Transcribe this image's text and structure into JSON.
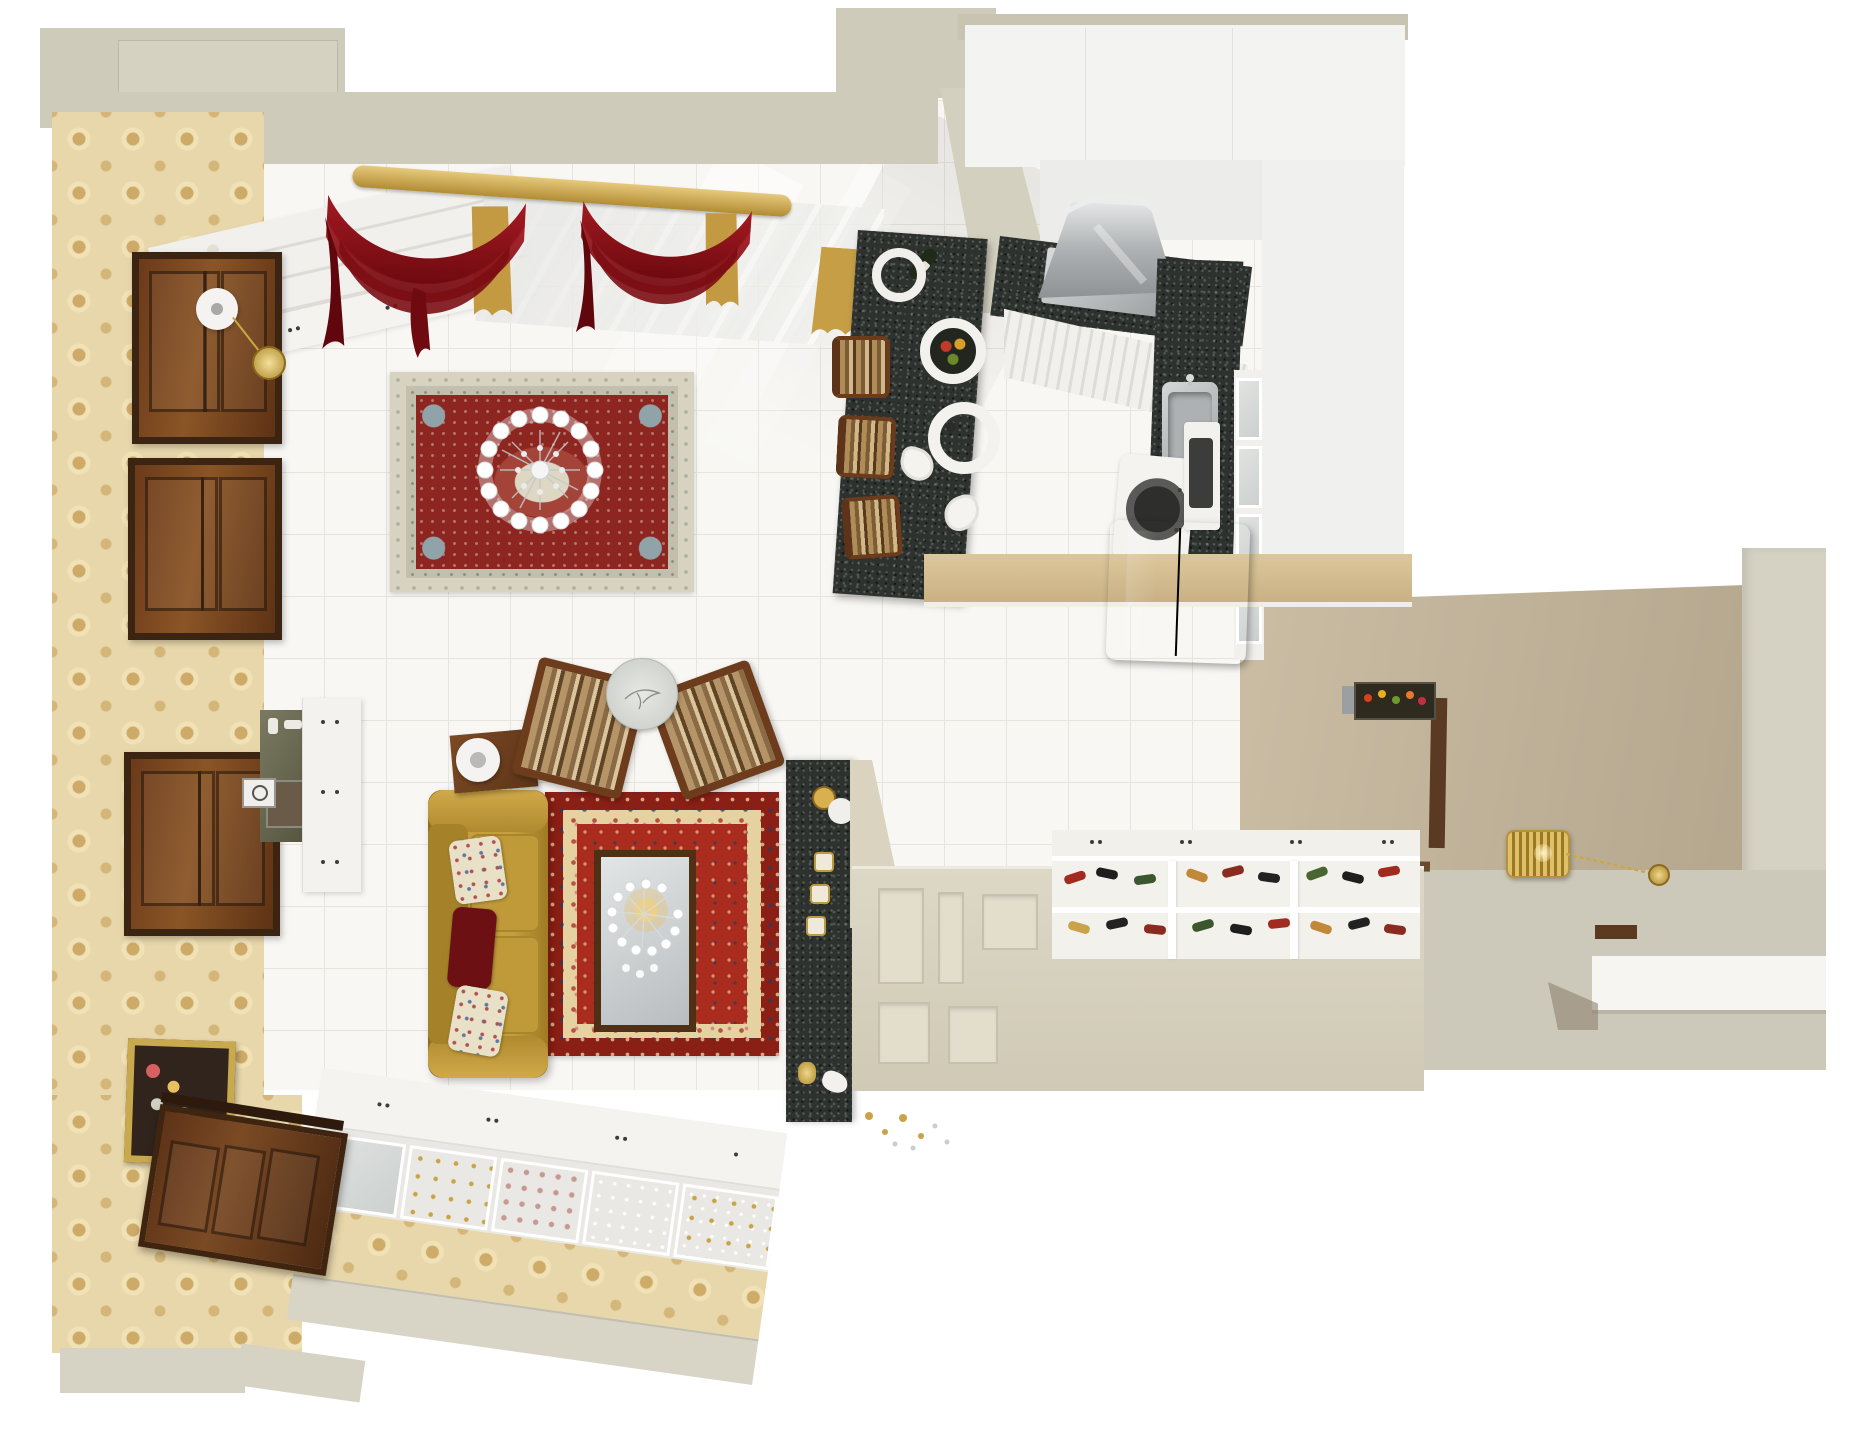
{
  "meta": {
    "title": "Bird's-eye 3D render of an apartment interior",
    "style": "photorealistic top-down floor plan",
    "canvas": {
      "width_px": 1864,
      "height_px": 1440
    }
  },
  "palette": {
    "outer_wall": "#cfcbba",
    "wallpaper_damask": "#e8d7ab",
    "damask_motif": "#cda864",
    "tile_floor": "#f8f7f4",
    "tile_grout": "#e7e4de",
    "bookshelf_white": "#f1f0ed",
    "curtain_burgundy": "#7c0d13",
    "curtain_sheer_gold": "#c49c44",
    "curtain_rod_gold": "#d9b85c",
    "rug_main_border_cream": "#d7d3c0",
    "rug_main_field_red": "#8d2520",
    "rug_accent_blue": "#8fa3a8",
    "rug_small_border_red": "#8a1f15",
    "rug_small_field_red": "#a92c1f",
    "rug_small_navy": "#33476b",
    "sofa_gold": "#bb9332",
    "pillow_burgundy": "#6d1014",
    "pillow_floral_cream": "#e8dfc6",
    "wood_dark": "#6b3a1a",
    "granite_black": "#2e322f",
    "stainless_steel": "#c8cacb",
    "fridge_black": "#121212",
    "appliance_white": "#f3f2ef",
    "cabinet_white": "#f4f3f0",
    "entry_wall_taupe": "#c5b79d",
    "partition_beige": "#d7d1be",
    "lantern_gold": "#d9b85c",
    "mirror_glass": "#d3d6d8"
  },
  "rooms": {
    "living_room": {
      "label": "Living room",
      "floor": "white ceramic tile",
      "west_wall": {
        "finish": "beige damask wallpaper",
        "wood_panels": 3,
        "painting": "gold-framed floral still life",
        "wall_clock_with_pendulum": true
      },
      "north_wall": {
        "bookshelf": "white shelving filled with books",
        "windows": "gold rod with burgundy swag curtains and gold sheers",
        "curtain_swags": 2
      },
      "area_rug_main": {
        "style": "Persian, cream border with red medallion field",
        "chandelier_above": "crystal ring with white candle cups"
      },
      "area_rug_small": {
        "style": "Persian, red field with navy and cream ornament",
        "mirrored_coffee_table": "dark wood frame",
        "chandelier_above": "crystal with warm gold glow"
      },
      "sofa": {
        "upholstery": "mustard gold",
        "pillows": [
          "cream floral",
          "burgundy",
          "cream floral"
        ]
      },
      "armchairs": {
        "count": 2,
        "upholstery": "brown striped",
        "frame": "dark wood"
      },
      "round_table": "glass top with etched branch",
      "side_table": {
        "material": "dark wood",
        "lamp": "white globe"
      },
      "storage": {
        "white_sideboard": true,
        "olive_console_with_mirror": true,
        "small_clock": true
      },
      "south_wall": {
        "display_cabinets": "white with glass doors and crystalware",
        "wallpaper_band": "beige damask",
        "entry_door": "dark panelled wood"
      },
      "granite_console": {
        "material": "black granite",
        "decor": [
          "gold candlesticks",
          "white tray",
          "gold vase"
        ]
      }
    },
    "kitchen": {
      "label": "Kitchen",
      "cabinets": "white",
      "counters": "black speckled granite",
      "range_hood": "stainless steel",
      "cooktop": "stainless with dark burners",
      "sink": "stainless single bowl with faucet",
      "appliances": [
        "white washing machine",
        "white microwave",
        "glossy black refrigerator"
      ],
      "glass_cabinet_column": true,
      "counter_band": "tan top over lower cabinets",
      "decor": "small framed flower picture"
    },
    "dining_bar": {
      "label": "Dining bar",
      "top": "black granite island",
      "stools": {
        "count": 3,
        "style": "striped seats with dark wood frames"
      },
      "tableware": [
        "white ring plates",
        "wedge plates",
        "fruit bowl",
        "wine bottle"
      ]
    },
    "entry_hall": {
      "label": "Entry hall",
      "walls": "taupe",
      "pendant_light": "gold openwork lantern with chain and ceiling rose",
      "shoe_cabinet": {
        "finish": "white",
        "open_compartments": 6,
        "contents": "pairs of shoes"
      },
      "panelled_partition": "beige with recessed panels",
      "bench_shelf": "white slab",
      "threshold": "dark wood strip"
    }
  }
}
